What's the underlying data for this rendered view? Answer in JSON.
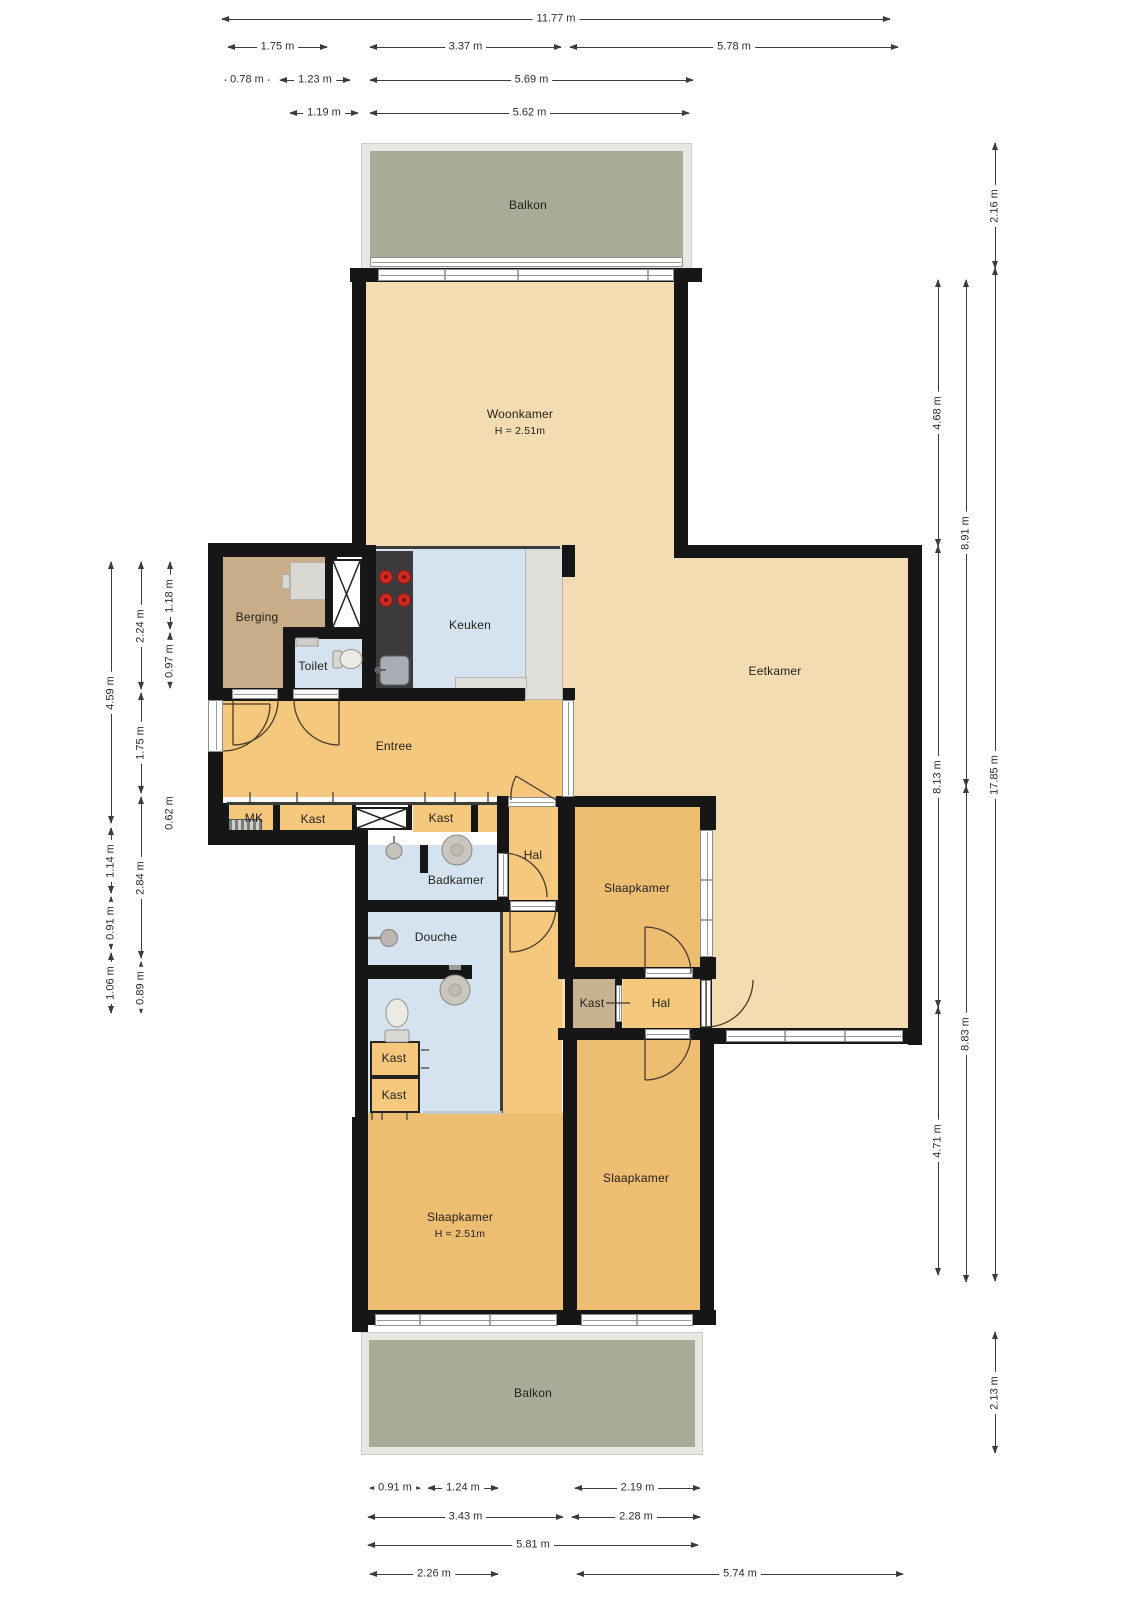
{
  "floorplan": {
    "rooms": {
      "balkon_top": "Balkon",
      "woonkamer": "Woonkamer",
      "woonkamer_height": "H = 2.51m",
      "berging": "Berging",
      "toilet": "Toilet",
      "keuken": "Keuken",
      "entree": "Entree",
      "eetkamer": "Eetkamer",
      "mk": "MK",
      "kast_entree_links": "Kast",
      "kast_entree_rechts": "Kast",
      "hal_boven": "Hal",
      "badkamer": "Badkamer",
      "slaapkamer_midden": "Slaapkamer",
      "douche": "Douche",
      "kast_badkamer_1": "Kast",
      "kast_badkamer_2": "Kast",
      "kast_hal": "Kast",
      "hal_onder": "Hal",
      "slaapkamer_rechts": "Slaapkamer",
      "slaapkamer_links": "Slaapkamer",
      "slaapkamer_links_height": "H = 2.51m",
      "balkon_onder": "Balkon"
    },
    "dimensions": {
      "top": [
        "11.77 m",
        "1.75 m",
        "3.37 m",
        "5.78 m",
        "0.78 m",
        "1.23 m",
        "5.69 m",
        "1.19 m",
        "5.62 m"
      ],
      "bottom": [
        "0.91 m",
        "1.24 m",
        "2.19 m",
        "3.43 m",
        "2.28 m",
        "5.81 m",
        "2.26 m",
        "5.74 m"
      ],
      "left": [
        "4.59 m",
        "1.14 m",
        "0.91 m",
        "1.06 m",
        "2.24 m",
        "1.75 m",
        "2.84 m",
        "0.89 m",
        "1.18 m",
        "0.97 m",
        "0.62 m"
      ],
      "right": [
        "4.68 m",
        "8.13 m",
        "4.71 m",
        "8.91 m",
        "8.83 m",
        "2.16 m",
        "17.85 m",
        "2.13 m"
      ]
    },
    "colors": {
      "wall": "#161616",
      "living_area": "#f3dcb2",
      "circulation": "#f6c87d",
      "bedroom": "#edbd72",
      "wet_room": "#d5e2f0",
      "storage": "#c8ad88",
      "balcony": "#a8ab96",
      "balcony_frame": "#e8e8e3",
      "counter": "#3c3c3c",
      "cooktop": "#cc2a22"
    }
  }
}
